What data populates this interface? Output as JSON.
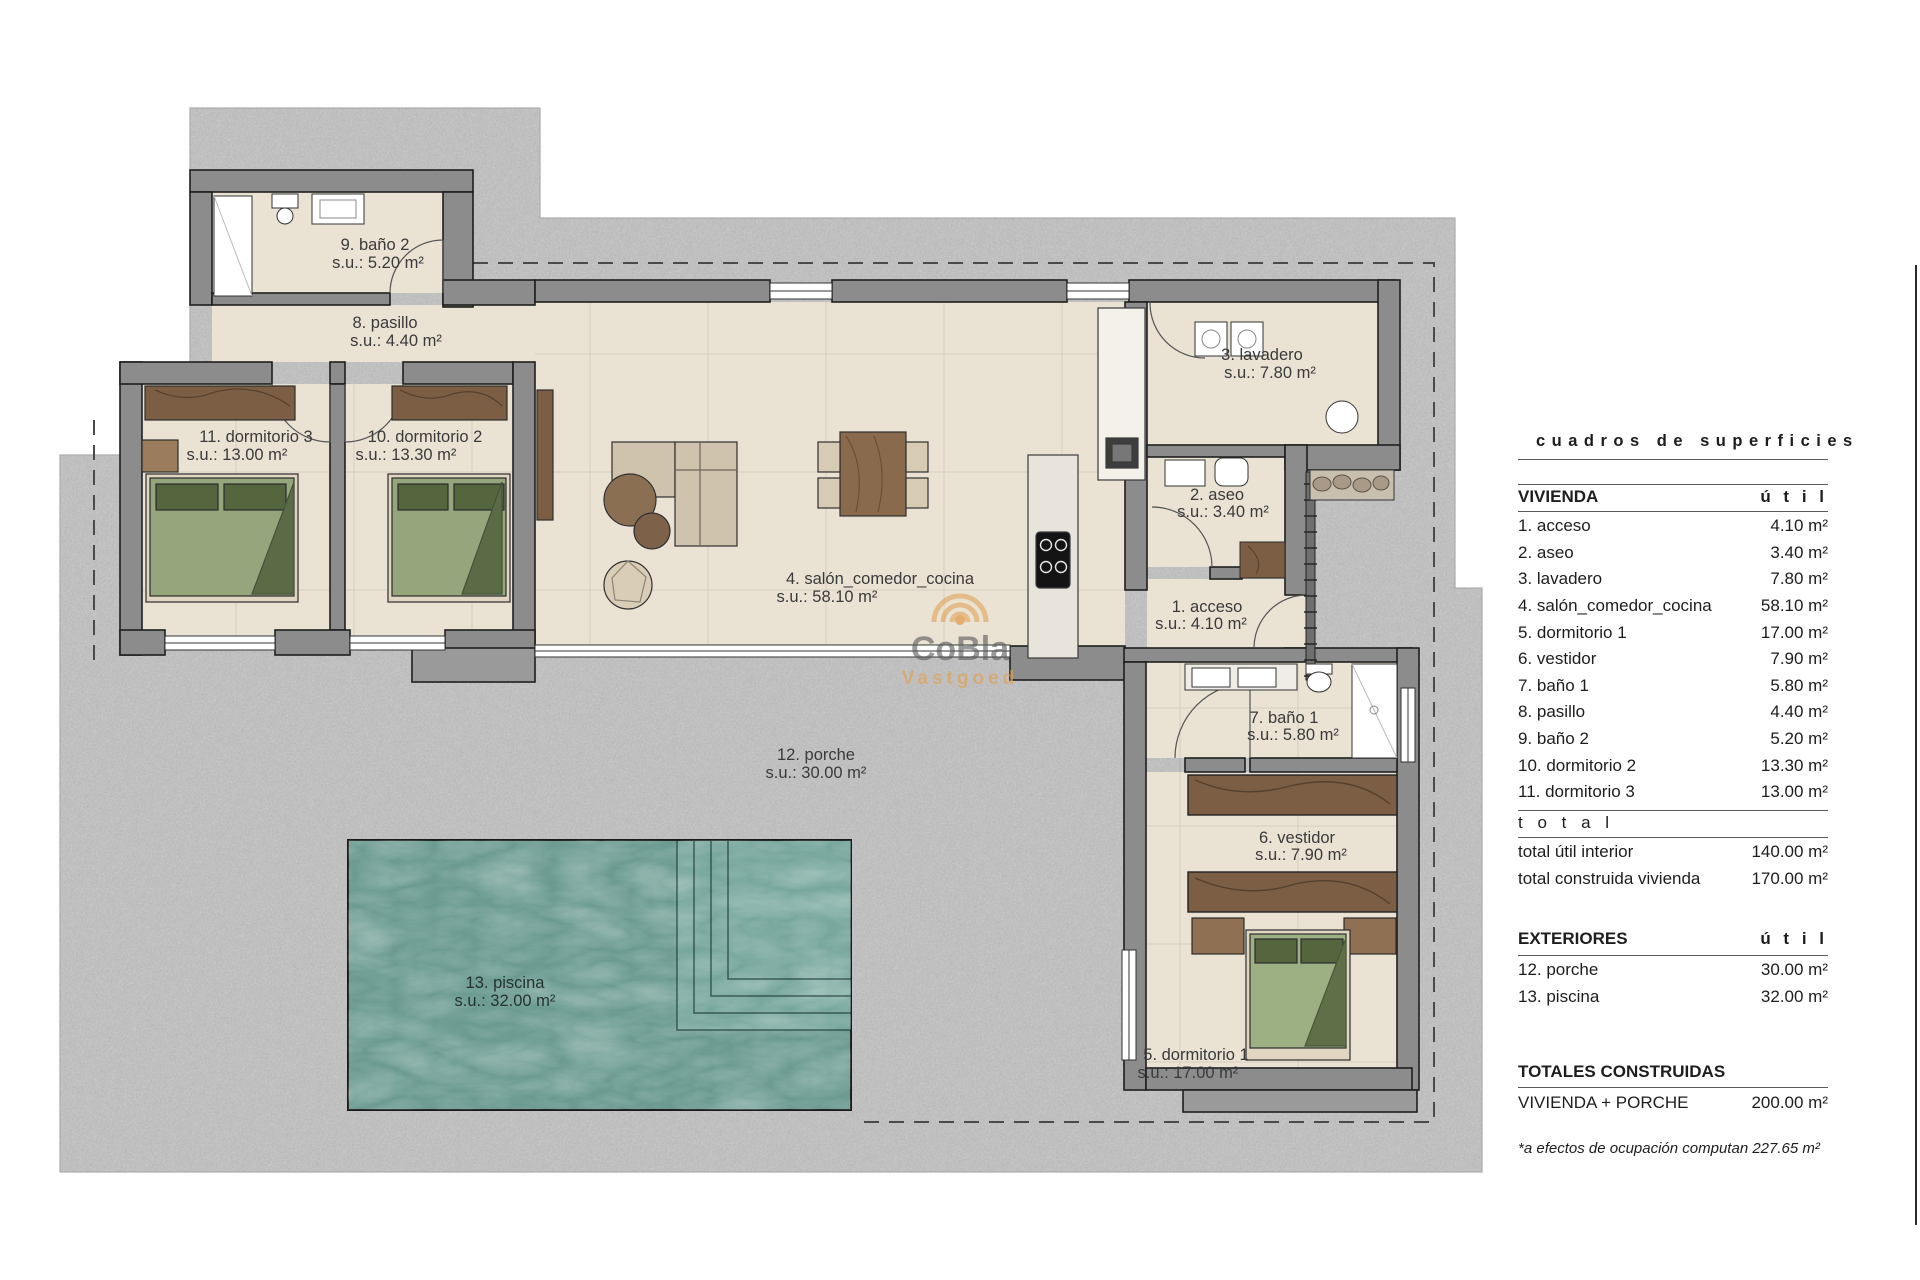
{
  "plan": {
    "rooms": {
      "bano2": {
        "name": "9. baño 2",
        "su": "s.u.: 5.20 m²"
      },
      "pasillo": {
        "name": "8. pasillo",
        "su": "s.u.: 4.40 m²"
      },
      "dorm3": {
        "name": "11. dormitorio 3",
        "su": "s.u.: 13.00 m²"
      },
      "dorm2": {
        "name": "10. dormitorio 2",
        "su": "s.u.: 13.30 m²"
      },
      "salon": {
        "name": "4. salón_comedor_cocina",
        "su": "s.u.: 58.10 m²"
      },
      "lavadero": {
        "name": "3. lavadero",
        "su": "s.u.: 7.80 m²"
      },
      "aseo": {
        "name": "2. aseo",
        "su": "s.u.: 3.40 m²"
      },
      "acceso": {
        "name": "1. acceso",
        "su": "s.u.: 4.10 m²"
      },
      "bano1": {
        "name": "7. baño 1",
        "su": "s.u.: 5.80 m²"
      },
      "vestidor": {
        "name": "6. vestidor",
        "su": "s.u.: 7.90 m²"
      },
      "dorm1": {
        "name": "5. dormitorio 1",
        "su": "s.u.: 17.00 m²"
      },
      "porche": {
        "name": "12. porche",
        "su": "s.u.: 30.00 m²"
      },
      "piscina": {
        "name": "13. piscina",
        "su": "s.u.: 32.00 m²"
      }
    },
    "watermark": {
      "brand": "CoBla",
      "sub": "Vastgoed"
    },
    "colors": {
      "terrain": "#b5b5b5",
      "floor": "#eae3d4",
      "wall": "#8c8c8c",
      "pool": "#68988f",
      "wood": "#7b5e43",
      "wood_light": "#8a6a4c",
      "bed_green": "#95a67c",
      "pillow_green": "#55663f",
      "accent_orange": "#dfa258",
      "label_text": "#3a3a3a"
    }
  },
  "table": {
    "title": "cuadros de superficies",
    "util_label": "ú t i l",
    "total_label": "t o t a l",
    "vivienda": {
      "header": "VIVIENDA",
      "rows": [
        {
          "label": "1. acceso",
          "value": "4.10 m²"
        },
        {
          "label": "2. aseo",
          "value": "3.40 m²"
        },
        {
          "label": "3. lavadero",
          "value": "7.80 m²"
        },
        {
          "label": "4. salón_comedor_cocina",
          "value": "58.10 m²"
        },
        {
          "label": "5. dormitorio 1",
          "value": "17.00 m²"
        },
        {
          "label": "6. vestidor",
          "value": "7.90 m²"
        },
        {
          "label": "7. baño 1",
          "value": "5.80 m²"
        },
        {
          "label": "8. pasillo",
          "value": "4.40 m²"
        },
        {
          "label": "9. baño 2",
          "value": "5.20 m²"
        },
        {
          "label": "10. dormitorio 2",
          "value": "13.30 m²"
        },
        {
          "label": "11. dormitorio 3",
          "value": "13.00 m²"
        }
      ],
      "totals": [
        {
          "label": "total útil interior",
          "value": "140.00 m²"
        },
        {
          "label": "total construida vivienda",
          "value": "170.00 m²"
        }
      ]
    },
    "exteriores": {
      "header": "EXTERIORES",
      "rows": [
        {
          "label": "12. porche",
          "value": "30.00 m²"
        },
        {
          "label": "13. piscina",
          "value": "32.00 m²"
        }
      ]
    },
    "totales": {
      "header": "TOTALES CONSTRUIDAS",
      "rows": [
        {
          "label": "VIVIENDA + PORCHE",
          "value": "200.00 m²"
        }
      ]
    },
    "footnote": "*a efectos de ocupación computan 227.65 m²"
  }
}
